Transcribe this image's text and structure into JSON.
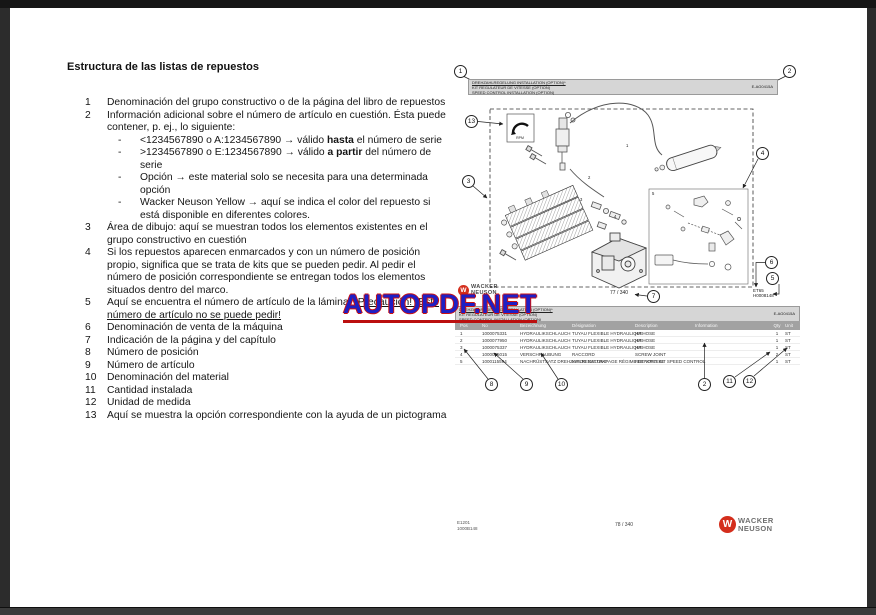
{
  "watermark": {
    "text": "AUTOPDF.NET",
    "fill_color": "#1f1fc4",
    "outline_color": "#cc1111"
  },
  "doc": {
    "heading": "Estructura de las listas de repuestos",
    "list": {
      "bullet": "-",
      "i1": {
        "n": "1",
        "t": "Denominación del grupo constructivo o de la página del libro de repuestos"
      },
      "i2": {
        "n": "2",
        "t": "Información adicional sobre el número de artículo en cuestión. Ésta puede contener, p. ej., lo siguiente:"
      },
      "i2a": {
        "pre": "<1234567890 o A:1234567890 → válido ",
        "b": "hasta",
        "post": " el número de serie"
      },
      "i2b": {
        "pre": ">1234567890 o E:1234567890 → válido ",
        "b": "a partir",
        "post": " del número de serie"
      },
      "i2c": {
        "t": "Opción → este material solo se necesita para una determinada opción"
      },
      "i2d": {
        "t": "Wacker Neuson Yellow → aquí se indica el color del repuesto si está disponible en diferentes colores."
      },
      "i3": {
        "n": "3",
        "t": "Área de dibujo: aquí se muestran todos los elementos existentes en el grupo constructivo en cuestión"
      },
      "i4": {
        "n": "4",
        "t": "Si los repuestos aparecen enmarcados y con un número de posición propio, significa que se trata de kits que se pueden pedir. Al pedir el número de posición correspondiente se entregan todos los elementos situados dentro del marco."
      },
      "i5": {
        "n": "5",
        "pre": "Aquí se encuentra el número de artículo de la lámina. ",
        "u": "¡Precaución! ¡Este número de artículo no se puede pedir!"
      },
      "i6": {
        "n": "6",
        "t": "Denominación de venta de la máquina"
      },
      "i7": {
        "n": "7",
        "t": "Indicación de la página y del capítulo"
      },
      "i8": {
        "n": "8",
        "t": "Número de posición"
      },
      "i9": {
        "n": "9",
        "t": "Número de artículo"
      },
      "i10": {
        "n": "10",
        "t": "Denominación del material"
      },
      "i11": {
        "n": "11",
        "t": "Cantidad instalada"
      },
      "i12": {
        "n": "12",
        "t": "Unidad de medida"
      },
      "i13": {
        "n": "13",
        "t": "Aquí se muestra la opción correspondiente con la ayuda de un pictograma"
      }
    }
  },
  "figure1": {
    "header": {
      "l1": "DREHZAHLREGELUNG INSTALLATION (OPTION)*",
      "l2": "KIT REGULATEUR DE VITESSE (OPTION)",
      "l3": "SPEED CONTROL INSTALLATION (OPTION)",
      "code": "E-AG0415A"
    },
    "pictogram_label": "RPM",
    "callouts": {
      "c1": "1",
      "c2": "2",
      "c3": "3",
      "c4": "4",
      "c5": "5",
      "c6": "6",
      "c7": "7",
      "c13": "13"
    },
    "part_labels": {
      "p1": "1",
      "p2": "2",
      "p3": "3",
      "p4": "4",
      "p5": "5"
    },
    "machine_ref_1": "ET65",
    "machine_ref_2": "H0008148",
    "page_ref": "77 / 340",
    "logo": {
      "w": "W",
      "l1": "WACKER",
      "l2": "NEUSON"
    }
  },
  "figure2": {
    "header": {
      "l1": "DREHZAHLREGELUNG INSTALLATION (OPTION)*",
      "l2": "KIT REGULATEUR DE VITESSE (OPTION)",
      "l3": "SPEED CONTROL INSTALLATION (OPTION)",
      "code": "E-AG0415A"
    },
    "columns": {
      "pos": "Pos",
      "no": "No",
      "de": "Bezeichnung",
      "fr": "Désignation",
      "en": "Description",
      "info": "Information",
      "qty": "Qty",
      "unit": "Unit"
    },
    "rows": [
      {
        "pos": "1",
        "no": "1000075331",
        "de": "HYDRAULIKSCHLAUCH",
        "fr": "TUYAU FLEXIBLE HYDRAULIQUE",
        "en": "HP HOSE",
        "info": "",
        "qty": "1",
        "unit": "ST"
      },
      {
        "pos": "2",
        "no": "1000077950",
        "de": "HYDRAULIKSCHLAUCH",
        "fr": "TUYAU FLEXIBLE HYDRAULIQUE",
        "en": "HP HOSE",
        "info": "",
        "qty": "1",
        "unit": "ST"
      },
      {
        "pos": "3",
        "no": "1000075337",
        "de": "HYDRAULIKSCHLAUCH",
        "fr": "TUYAU FLEXIBLE HYDRAULIQUE",
        "en": "HP HOSE",
        "info": "",
        "qty": "1",
        "unit": "ST"
      },
      {
        "pos": "4",
        "no": "1000015015",
        "de": "VERSCHRAUBUNG",
        "fr": "RACCORD",
        "en": "SCREW JOINT",
        "info": "",
        "qty": "2",
        "unit": "ST"
      },
      {
        "pos": "5",
        "no": "1000115594",
        "de": "NACHRÜSTSATZ DREHZAHLREGELUNG",
        "fr": "KIT DE RATTRAPAGE RÉGIME DE VITESSE",
        "en": "RETROFIT KIT SPEED CONTROL",
        "info": "",
        "qty": "1",
        "unit": "ST"
      }
    ],
    "callouts": {
      "c8": "8",
      "c9": "9",
      "c10": "10",
      "c2": "2",
      "c11": "11",
      "c12": "12"
    }
  },
  "footer": {
    "doc_line1": "E1201",
    "doc_line2": "1000B148",
    "page": "78 / 340",
    "logo": {
      "w": "W",
      "l1": "WACKER",
      "l2": "NEUSON"
    }
  }
}
